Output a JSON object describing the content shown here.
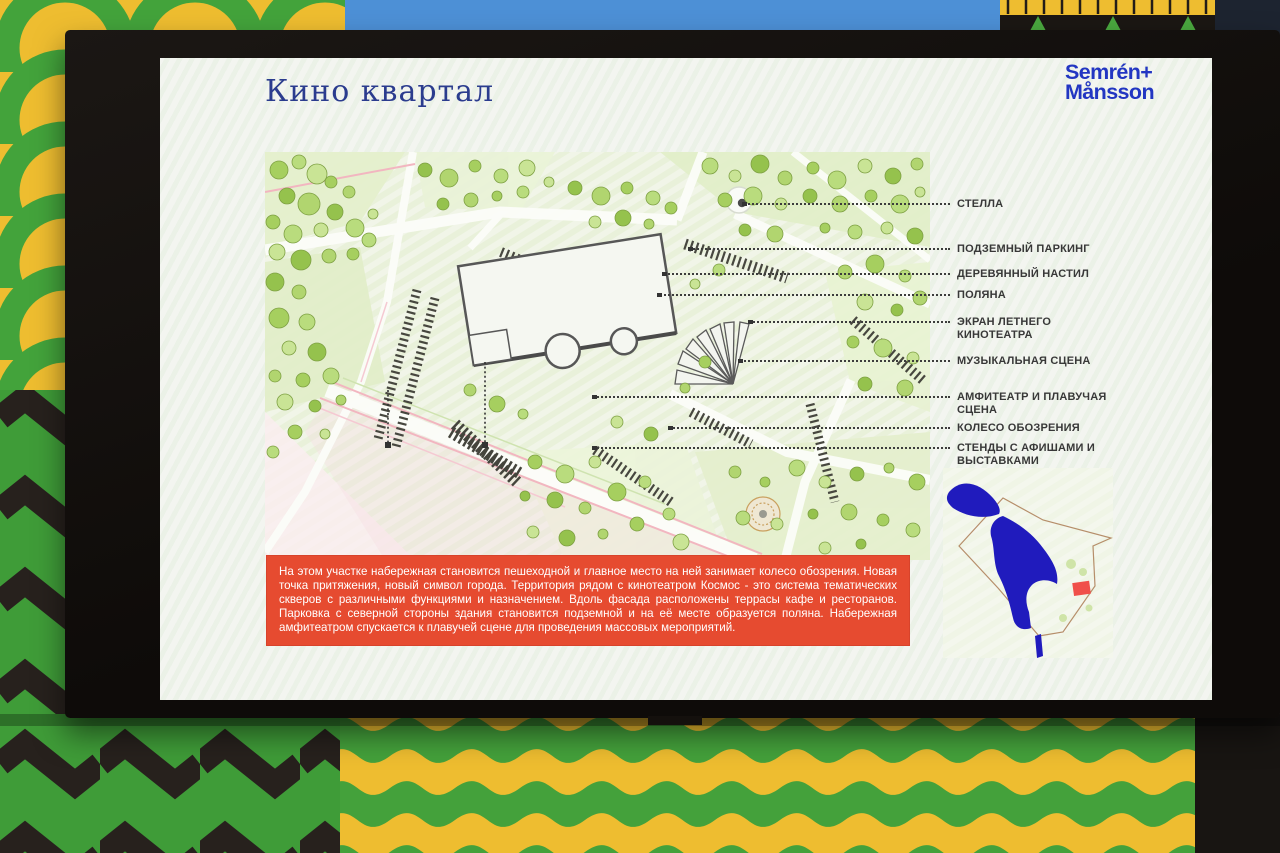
{
  "slide": {
    "title": "Кино квартал",
    "logo_line1": "Semrén+",
    "logo_line2": "Månsson",
    "plan_labels": [
      "СТЕЛЛА",
      "ПОДЗЕМНЫЙ ПАРКИНГ",
      "ДЕРЕВЯННЫЙ НАСТИЛ",
      "ПОЛЯНА",
      "ЭКРАН ЛЕТНЕГО КИНОТЕАТРА",
      "МУЗЫКАЛЬНАЯ СЦЕНА",
      "АМФИТЕАТР И ПЛАВУЧАЯ СЦЕНА",
      "КОЛЕСО ОБОЗРЕНИЯ",
      "СТЕНДЫ С АФИШАМИ И ВЫСТАВКАМИ"
    ],
    "description": "На этом участке набережная становится пешеходной и главное место на ней занимает колесо обозрения. Новая точка притяжения, новый символ города. Территория рядом с кинотеатром Космос - это система тематических скверов с различными функциями и назначением. Вдоль фасада расположены террасы кафе и ресторанов. Парковка с северной стороны здания становится подземной и на её месте образуется поляна. Набережная амфитеатром спускается к плавучей сцене для проведения массовых мероприятий.",
    "colors": {
      "accent_red": "#e64b30",
      "title_blue": "#2b3c8e",
      "logo_blue": "#2236c2",
      "mural_green": "#3f9c38",
      "mural_yellow": "#eebd30",
      "mural_blue": "#4d90d6",
      "water_blue": "#201bbd"
    }
  }
}
